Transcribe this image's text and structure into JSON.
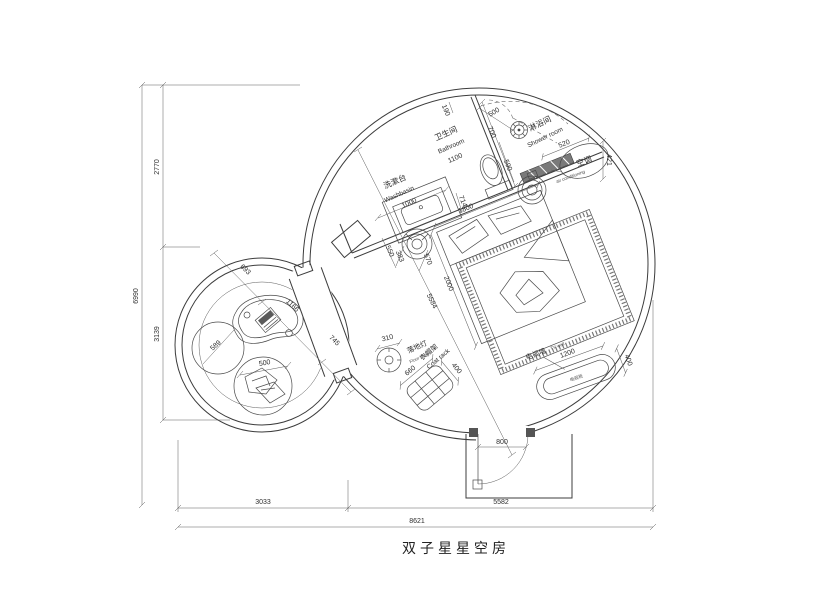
{
  "title": "双子星星空房",
  "overall": {
    "total_h": "6990",
    "upper_h": "2770",
    "lower_h": "3139",
    "left_w": "3033",
    "right_w": "5582",
    "total_w": "8621"
  },
  "bathroom": {
    "cn": "卫生间",
    "en": "Bathroom",
    "w": "1100",
    "gap": "190",
    "door": "700",
    "d": "590",
    "toilet_w": "714",
    "entry": "500"
  },
  "washbasin": {
    "cn": "洗漱台",
    "en": "Washbasin",
    "l": "1000",
    "d": "550"
  },
  "shower": {
    "cn": "淋浴间",
    "en": "Shower room"
  },
  "ac": {
    "cn": "空调",
    "en": "air conditioning",
    "l": "520",
    "off": "421"
  },
  "bed": {
    "w": "1800",
    "l": "2000",
    "diag": "5584",
    "side_a": "383",
    "side_b": "570"
  },
  "lamp": {
    "cn": "落地灯",
    "en": "Floor lamp",
    "dia": "310"
  },
  "coat": {
    "cn": "衣帽架",
    "en": "Coat rack",
    "w": "660",
    "d": "400"
  },
  "tv": {
    "cn": "电视墙",
    "en": "TV wall",
    "cabinet": "电视柜",
    "l": "1200",
    "d": "400"
  },
  "entry": {
    "door": "800"
  },
  "lounge": {
    "a": "693",
    "b": "1166",
    "c": "745",
    "pouf": "589",
    "chair": "500"
  }
}
